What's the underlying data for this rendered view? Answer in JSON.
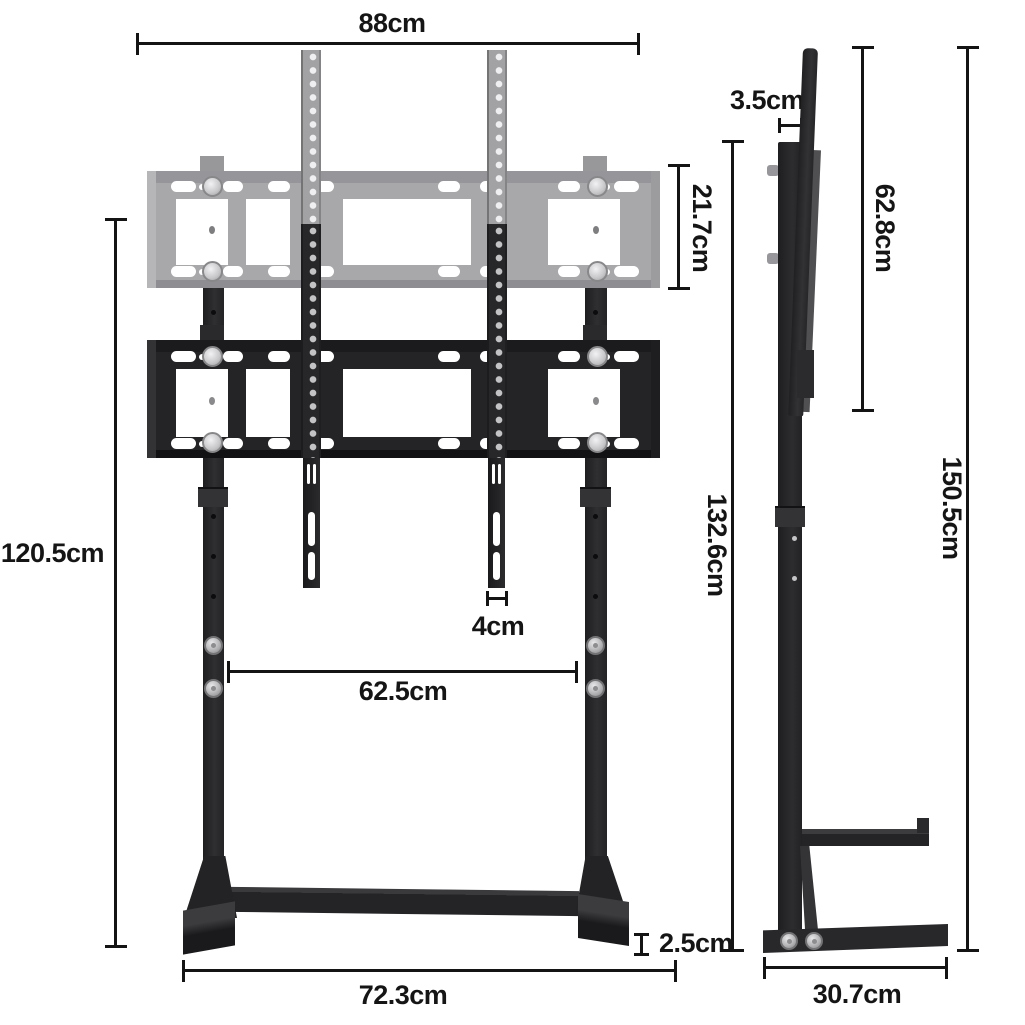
{
  "title": "TV floor stand dimension diagram",
  "front_view": {
    "top_width": "88cm",
    "overall_height": "120.5cm",
    "bracket_height": "21.7cm",
    "strip_width": "4cm",
    "upright_spacing": "62.5cm",
    "foot_thickness": "2.5cm",
    "base_width": "72.3cm"
  },
  "side_view": {
    "post_depth": "3.5cm",
    "bracket_plate_height": "62.8cm",
    "stand_height": "132.6cm",
    "total_height": "150.5cm",
    "base_depth": "30.7cm"
  },
  "colors": {
    "background": "#ffffff",
    "dimension_line": "#141414",
    "label_text": "#151515",
    "metal_black": "#28282a",
    "ghost_gray": "#a8a8aa",
    "screw_silver": "#c0c0c2"
  }
}
